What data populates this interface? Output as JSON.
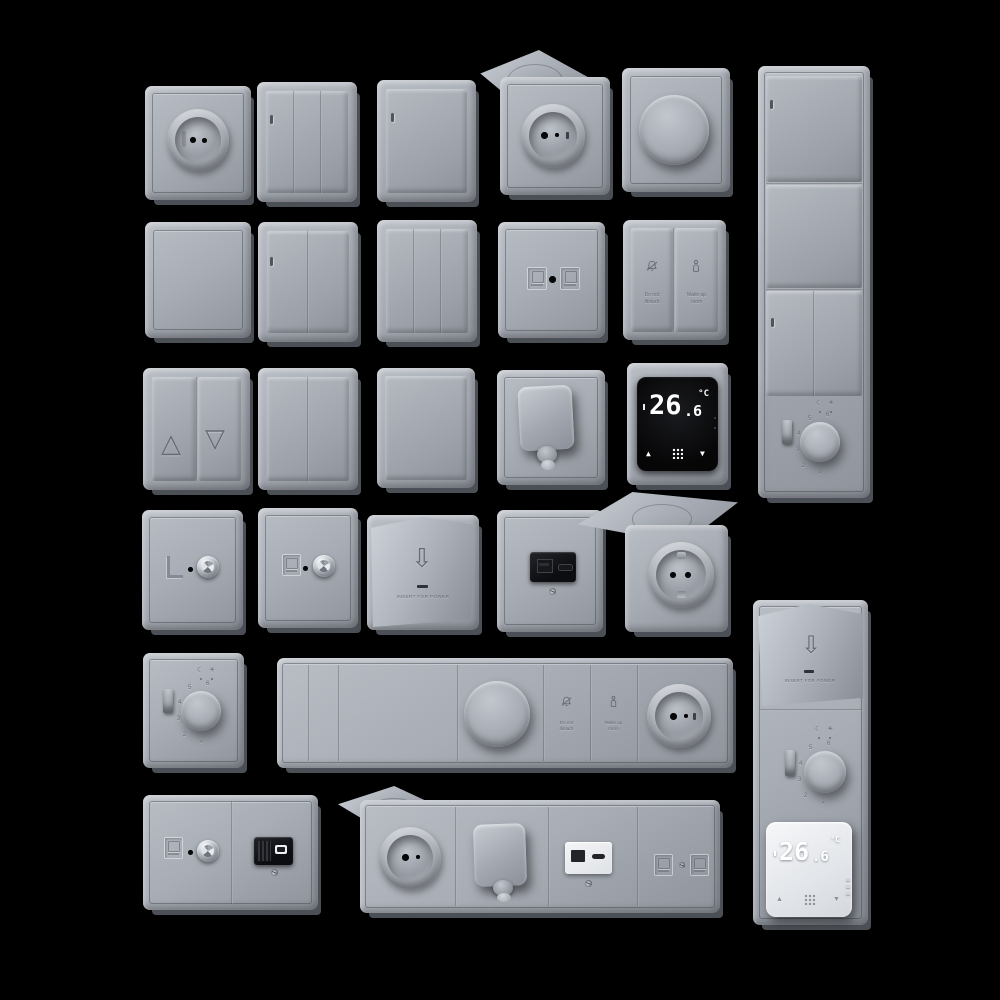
{
  "scene": {
    "description": "3D render: grid of gray electrical wall plates (switches, sockets, dimmers, thermostats, data and USB outlets) on a black background",
    "background_color": "#000000",
    "plate_color": "#a8adb5",
    "black_display_color": "#0b0c0e",
    "white_display_color": "#eef0f3"
  },
  "labels": {
    "do_not_disturb_line1": "Do not",
    "do_not_disturb_line2": "disturb",
    "make_up_room_line1": "Make up",
    "make_up_room_line2": "room",
    "insert_for_power": "INSERT FOR POWER"
  },
  "thermostat": {
    "temp_main": "26",
    "temp_frac": ".6",
    "unit": "°C",
    "up_icon": "▲",
    "down_icon": "▼"
  },
  "dial": {
    "n2": "2",
    "n3": "3",
    "n4": "4",
    "n5": "5",
    "n6": "6",
    "night_icon": "☾",
    "day_icon": "☀",
    "frost_icon": "*"
  },
  "blind": {
    "up_icon": "△",
    "down_icon": "▽"
  },
  "card": {
    "arrow_icon": "⇩"
  }
}
